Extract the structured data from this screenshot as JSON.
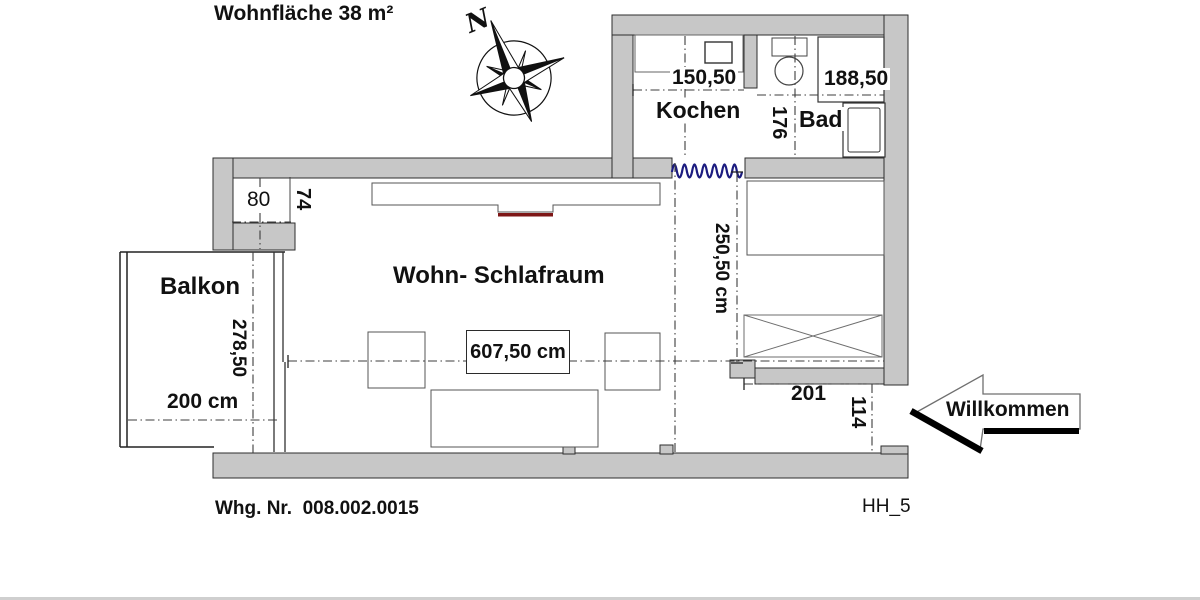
{
  "header": {
    "title": "Wohnfläche 38 m²"
  },
  "compass": {
    "north_label": "N"
  },
  "rooms": {
    "kochen": {
      "label": "Kochen",
      "width_dim": "150,50"
    },
    "bad": {
      "label": "Bad",
      "width_dim": "188,50",
      "depth_dim": "176"
    },
    "wohn_schlafraum": {
      "label": "Wohn- Schlafraum",
      "length_dim": "607,50 cm",
      "depth_dim": "250,50 cm"
    },
    "balkon": {
      "label": "Balkon",
      "depth_dim": "278,50",
      "width_dim": "200 cm"
    },
    "niche": {
      "width_dim": "80",
      "depth_dim": "74"
    },
    "entry": {
      "width_dim": "201",
      "depth_dim": "114"
    }
  },
  "entry_arrow": {
    "label": "Willkommen"
  },
  "footer": {
    "apartment_number": "Whg. Nr.  008.002.0015",
    "plan_code": "HH_5"
  },
  "colors": {
    "wall_fill": "#c7c7c7",
    "wall_stroke": "#2e2e2e",
    "curtain_blue": "#1c1c80",
    "accent_red": "#7d1616"
  }
}
